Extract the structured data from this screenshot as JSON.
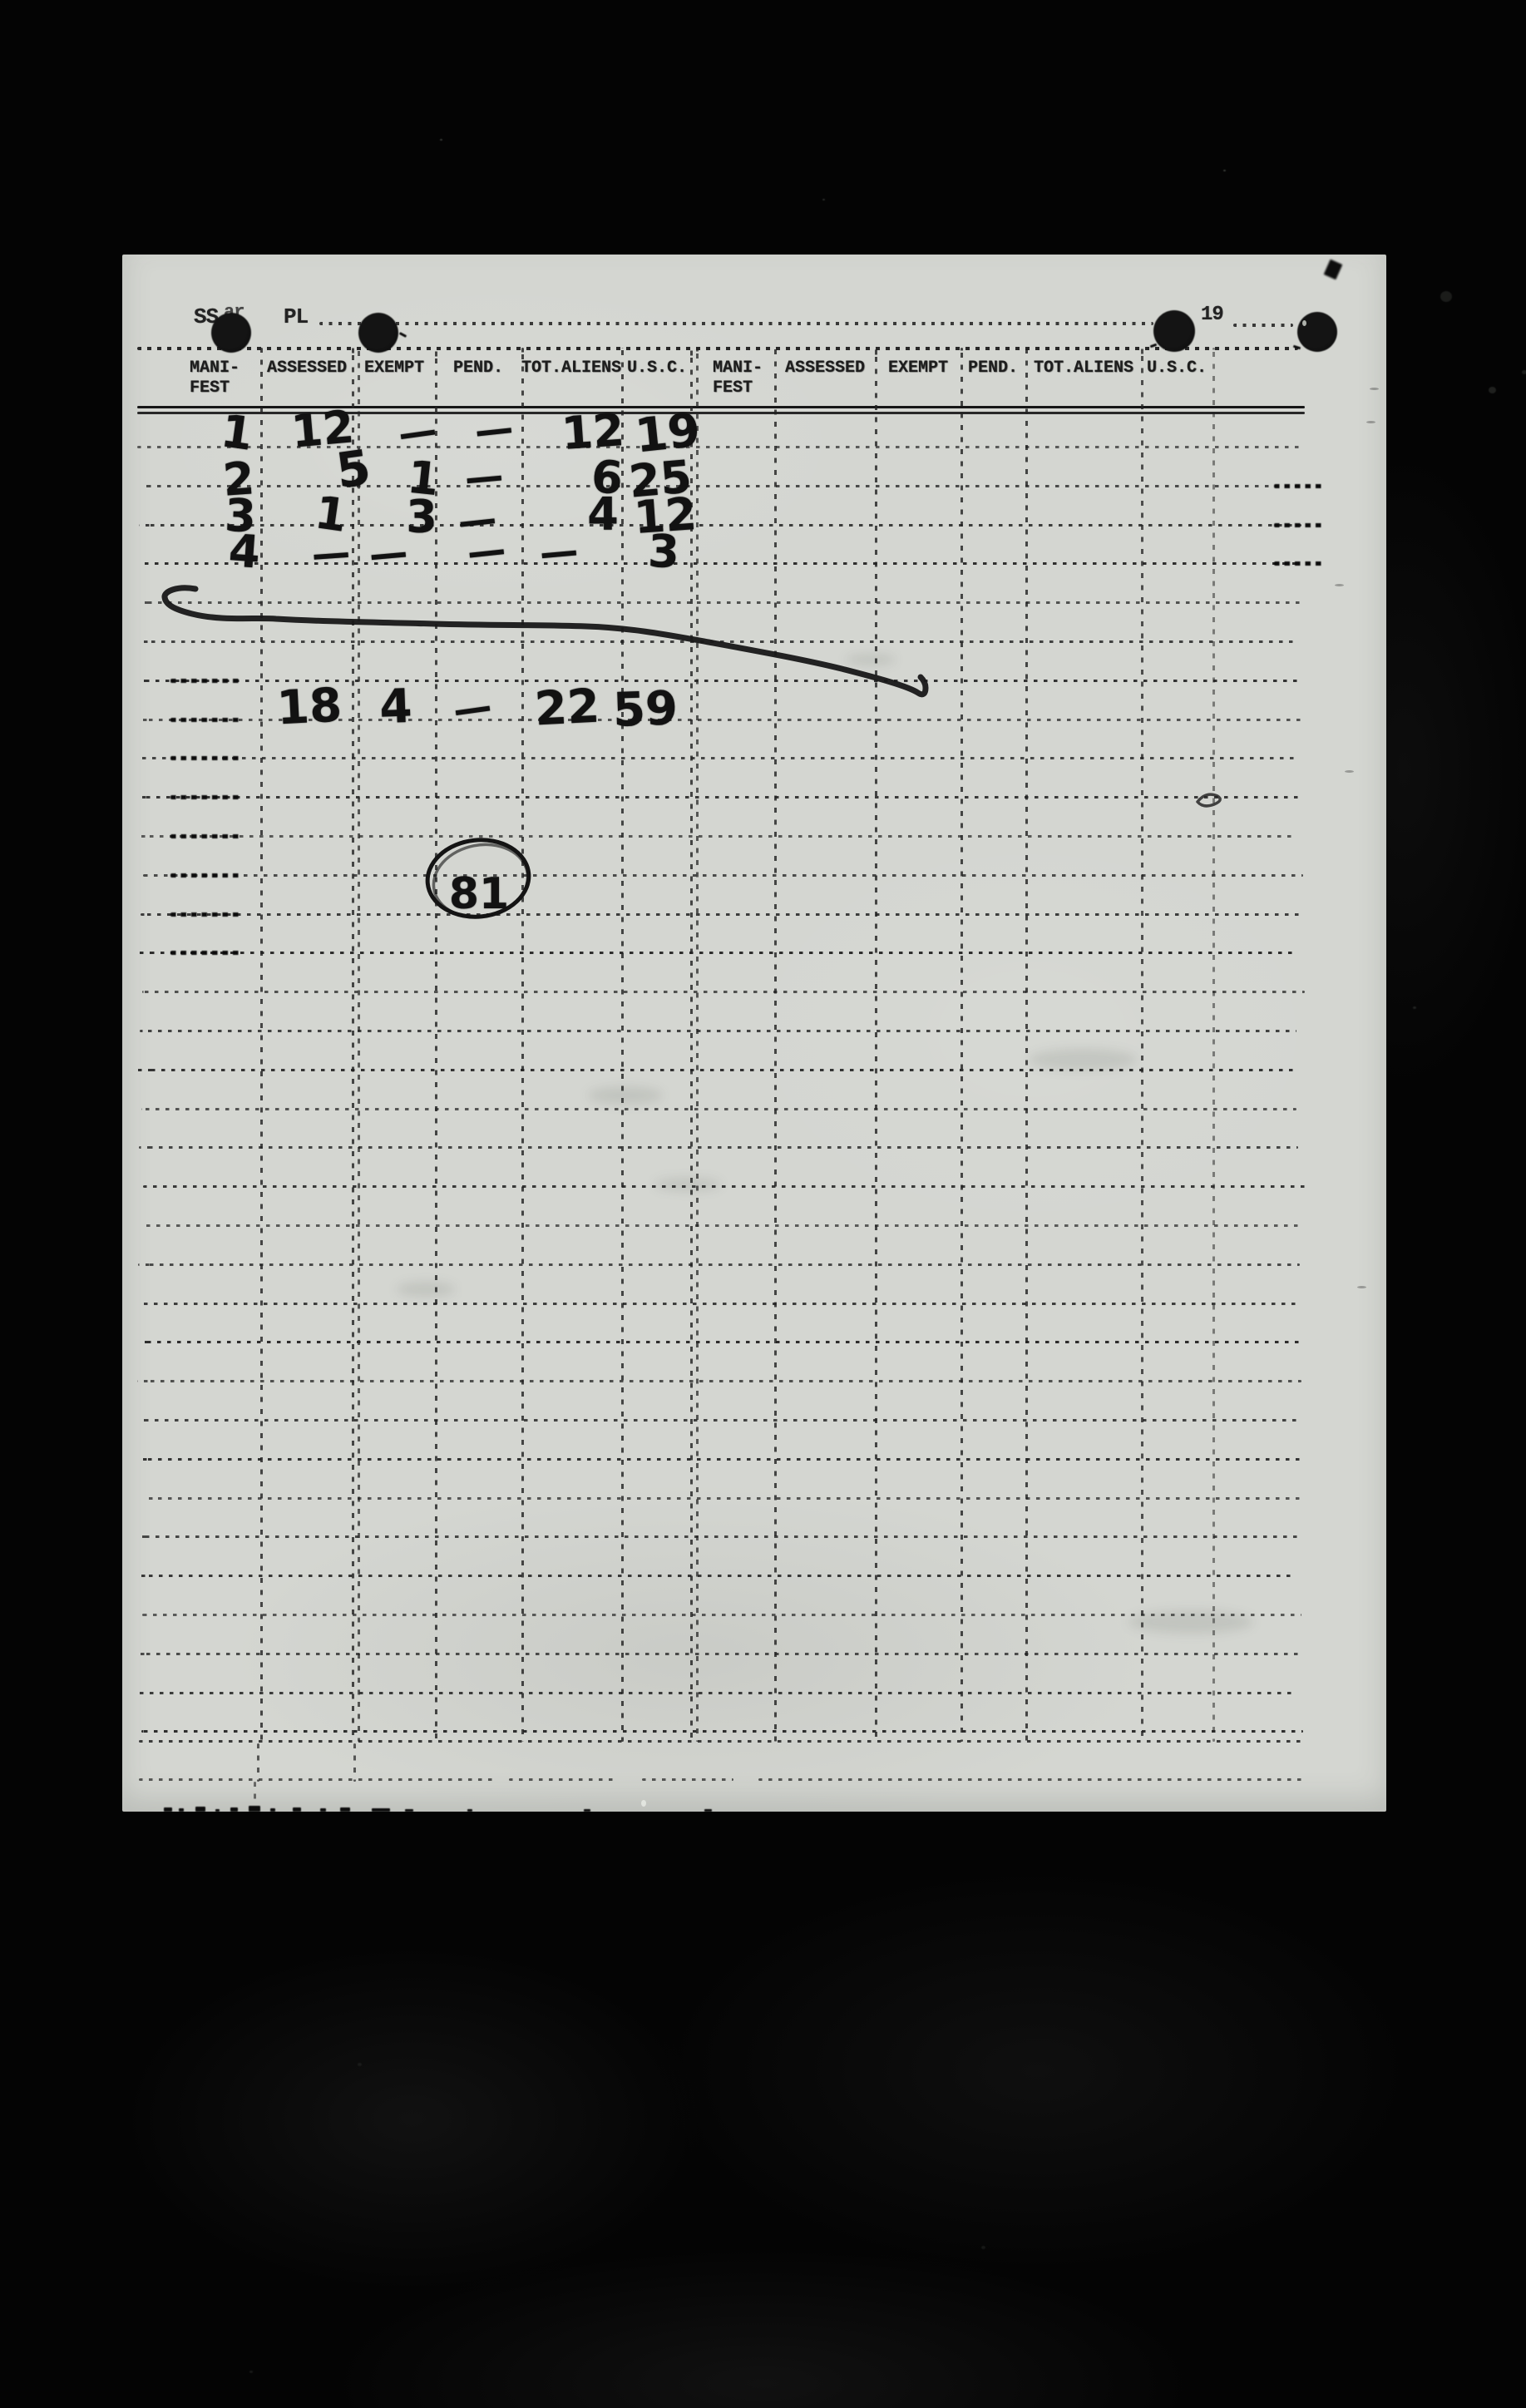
{
  "scan": {
    "header_line": {
      "vessel_prefix": "SS",
      "obscured_text": "ar",
      "vessel_suffix": "PL",
      "year_label": "19"
    },
    "table": {
      "group_count": 2,
      "columns": [
        {
          "label_line1": "MANI-",
          "label_line2": "FEST"
        },
        {
          "label_line1": "ASSESSED",
          "label_line2": ""
        },
        {
          "label_line1": "EXEMPT",
          "label_line2": ""
        },
        {
          "label_line1": "PEND.",
          "label_line2": ""
        },
        {
          "label_line1": "TOT.ALIENS",
          "label_line2": ""
        },
        {
          "label_line1": "U.S.C.",
          "label_line2": ""
        }
      ],
      "rows": [
        {
          "manifest": "1",
          "assessed": "12",
          "exempt": "—",
          "pend": "—",
          "tot_aliens": "12",
          "usc": "19"
        },
        {
          "manifest": "2",
          "assessed": "5",
          "exempt": "1",
          "pend": "—",
          "tot_aliens": "6",
          "usc": "25"
        },
        {
          "manifest": "3",
          "assessed": "1",
          "exempt": "3",
          "pend": "—",
          "tot_aliens": "4",
          "usc": "12"
        },
        {
          "manifest": "4",
          "assessed": "—",
          "exempt": "—",
          "pend": "—",
          "tot_aliens": "—",
          "usc": "3"
        }
      ],
      "totals_row": {
        "assessed": "18",
        "exempt": "4",
        "pend": "—",
        "tot_aliens": "22",
        "usc": "59"
      },
      "circled_value": "81"
    },
    "colors": {
      "paper": "#d4d6d1",
      "background": "#040404",
      "typed_ink": "#1c1c1c",
      "pencil_ink": "#111111"
    }
  }
}
